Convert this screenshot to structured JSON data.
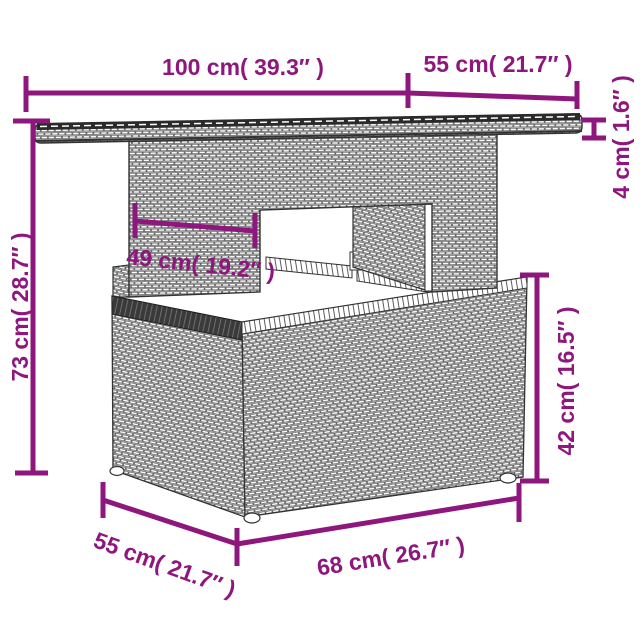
{
  "figure": {
    "description": "line drawing of poly rattan garden table with storage base",
    "accent_color": "#8e177e",
    "drawing_color": "#333333"
  },
  "dimensions": {
    "top_length": "100 cm( 39.3″ )",
    "top_depth": "55 cm( 21.7″ )",
    "top_thickness": "4 cm( 1.6″ )",
    "total_height": "73 cm( 28.7″ )",
    "inner_width": "49 cm( 19.2″ )",
    "base_height": "42 cm( 16.5″ )",
    "base_depth": "55 cm( 21.7″ )",
    "base_length": "68 cm( 26.7″ )"
  }
}
